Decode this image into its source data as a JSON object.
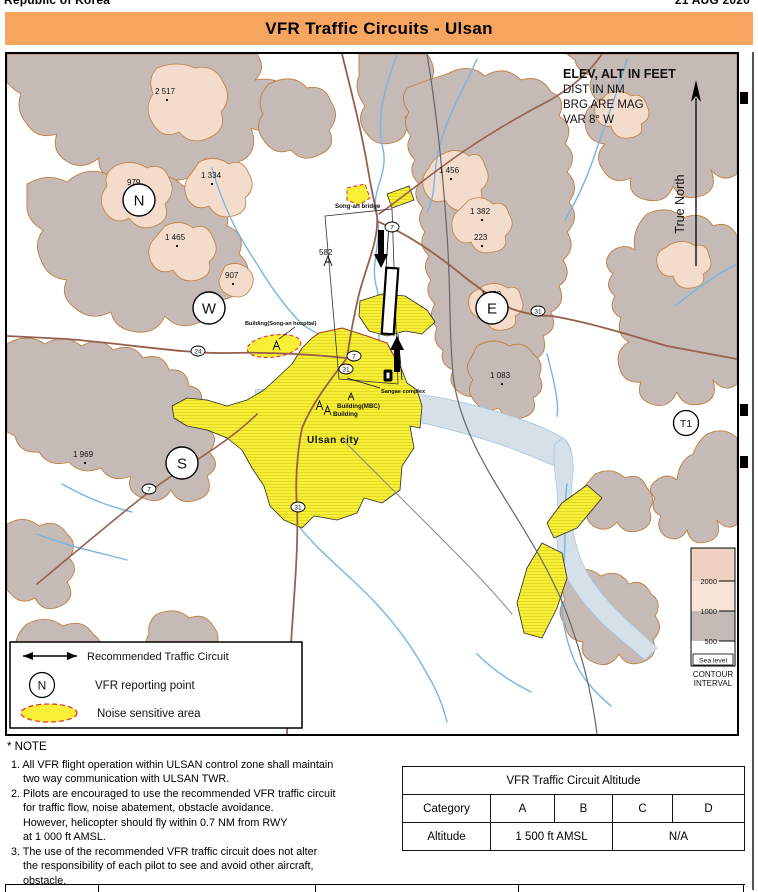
{
  "document": {
    "left_header": "Republic of Korea",
    "right_header": "21 AUG 2020"
  },
  "title_bar": {
    "title": "VFR Traffic Circuits - Ulsan",
    "color": "#f6a55f"
  },
  "map": {
    "info": {
      "elev": "ELEV, ALT IN FEET",
      "dist": "DIST IN NM",
      "brg": "BRG ARE MAG",
      "var": "VAR 8° W"
    },
    "true_north": "True North",
    "reporting_points": [
      {
        "label": "N"
      },
      {
        "label": "W"
      },
      {
        "label": "E"
      },
      {
        "label": "S"
      },
      {
        "label": "T1"
      }
    ],
    "spot_elevations": [
      "2 517",
      "979",
      "1 334",
      "1 465",
      "907",
      "582",
      "1 456",
      "1 382",
      "223",
      "1 479",
      "1 083",
      "1 969"
    ],
    "road_shields": [
      "7",
      "7",
      "31",
      "24",
      "31",
      "7",
      "31"
    ],
    "place_labels": {
      "bridge": "Song-an bridge",
      "hospital": "Building(Song-an hospital)",
      "mbc": "Building(MBC)",
      "building": "Building",
      "city": "Ulsan city",
      "complex": "Sangae complex"
    },
    "legend": {
      "circuit": "Recommended Traffic Circuit",
      "vfr_point_symbol": "N",
      "vfr_point": "VFR reporting point",
      "noise": "Noise sensitive area"
    },
    "contour": {
      "t2000": "2000",
      "t1000": "1000",
      "t500": "500",
      "sea_level": "Sea level",
      "caption1": "CONTOUR",
      "caption2": "INTERVAL"
    }
  },
  "notes": {
    "heading": "* NOTE",
    "item1": "1. All VFR flight operation within ULSAN control zone shall maintain\n    two way communication with ULSAN TWR.",
    "item2": "2. Pilots are encouraged to use the recommended VFR traffic circuit\n    for traffic flow, noise abatement, obstacle avoidance.\n    However, helicopter should fly within 0.7 NM from RWY\n    at 1 000 ft AMSL.",
    "item3": "3. The use of the recommended VFR traffic circuit does not alter\n    the responsibility of each pilot to see and avoid other aircraft,\n    obstacle."
  },
  "table": {
    "title": "VFR Traffic Circuit Altitude",
    "category_label": "Category",
    "cat_a": "A",
    "cat_b": "B",
    "cat_c": "C",
    "cat_d": "D",
    "altitude_label": "Altitude",
    "altitude_ab": "1 500 ft AMSL",
    "altitude_cd": "N/A"
  }
}
